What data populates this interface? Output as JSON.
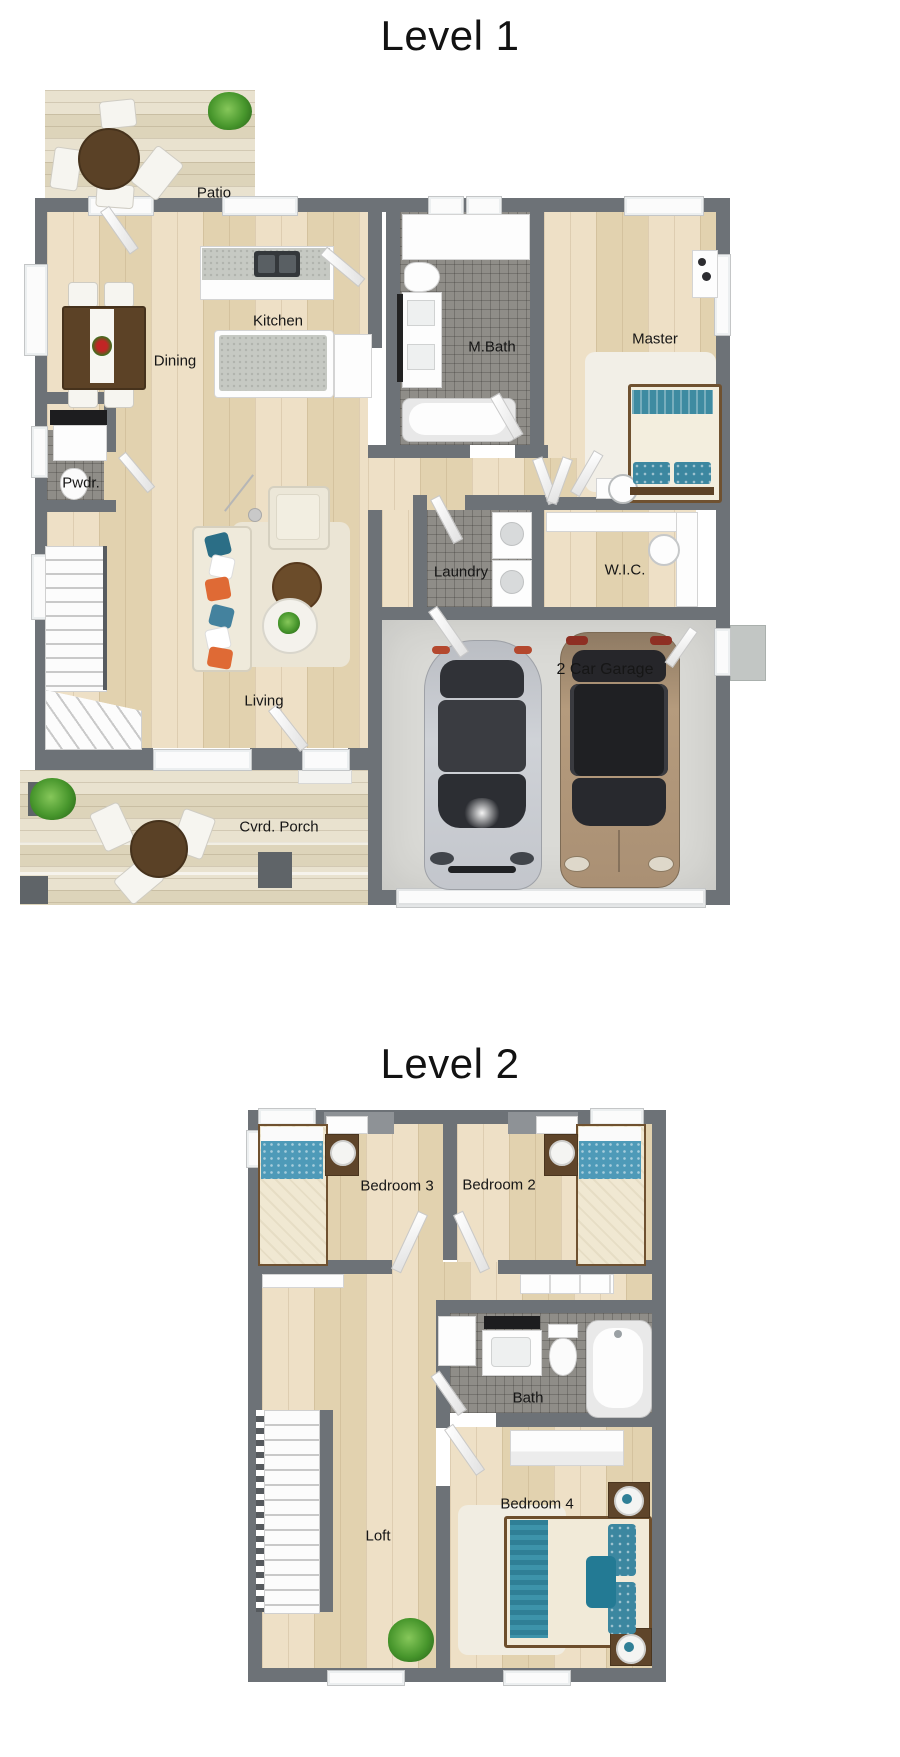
{
  "levels": [
    {
      "title": "Level 1",
      "rooms": [
        {
          "label": "Patio"
        },
        {
          "label": "Kitchen"
        },
        {
          "label": "Dining"
        },
        {
          "label": "M.Bath"
        },
        {
          "label": "Master"
        },
        {
          "label": "Pwdr."
        },
        {
          "label": "Laundry"
        },
        {
          "label": "W.I.C."
        },
        {
          "label": "Living"
        },
        {
          "label": "2 Car Garage"
        },
        {
          "label": "Cvrd. Porch"
        }
      ]
    },
    {
      "title": "Level 2",
      "rooms": [
        {
          "label": "Bedroom 3"
        },
        {
          "label": "Bedroom 2"
        },
        {
          "label": "Bath"
        },
        {
          "label": "Loft"
        },
        {
          "label": "Bedroom 4"
        }
      ]
    }
  ],
  "colors": {
    "wall": "#6d7277",
    "wood_floor": "#e9dcc1",
    "deck_plank": "#e6dfca",
    "tile_floor": "#8f8d88",
    "garage_floor": "#dadad6",
    "accent_teal": "#3c87a0",
    "accent_orange": "#df6a35",
    "furniture_brown": "#5c4226",
    "car_silver": "#c8cbd1",
    "car_tan": "#b2987a"
  }
}
